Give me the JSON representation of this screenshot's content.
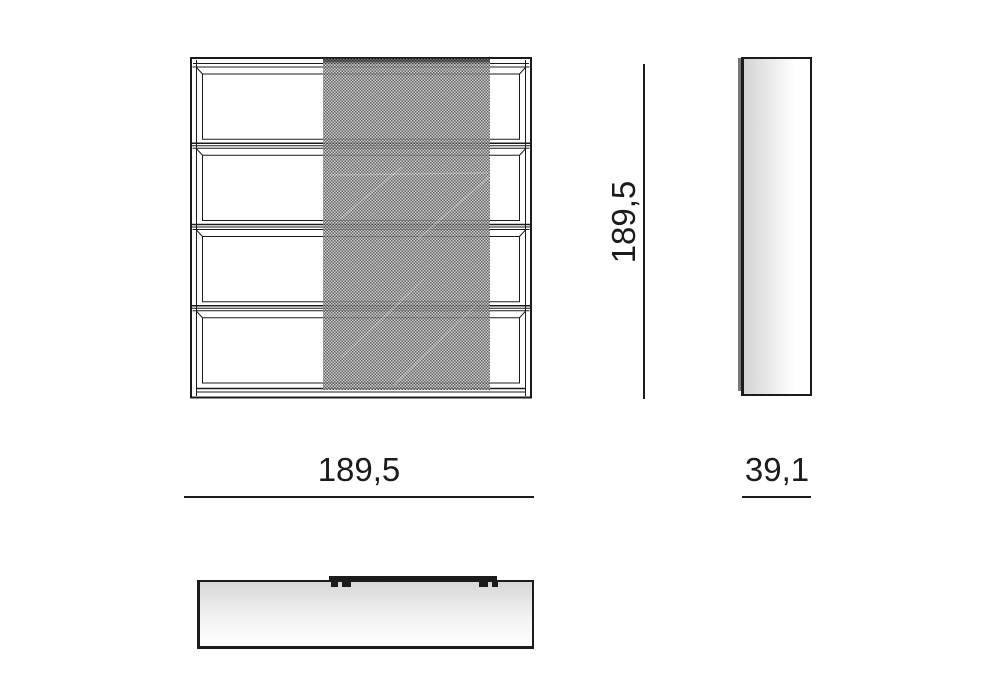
{
  "drawing": {
    "front_view": {
      "shelf_rows": 4,
      "has_mesh_sliding_panel": true
    },
    "dimensions": {
      "height_label": "189,5",
      "width_label": "189,5",
      "depth_label": "39,1"
    },
    "colors": {
      "line": "#1b1b1b",
      "mesh_dark": "#474747",
      "mesh_light": "#c6c6c6",
      "shade_gray": "#d3d3d3",
      "background": "#ffffff"
    }
  }
}
